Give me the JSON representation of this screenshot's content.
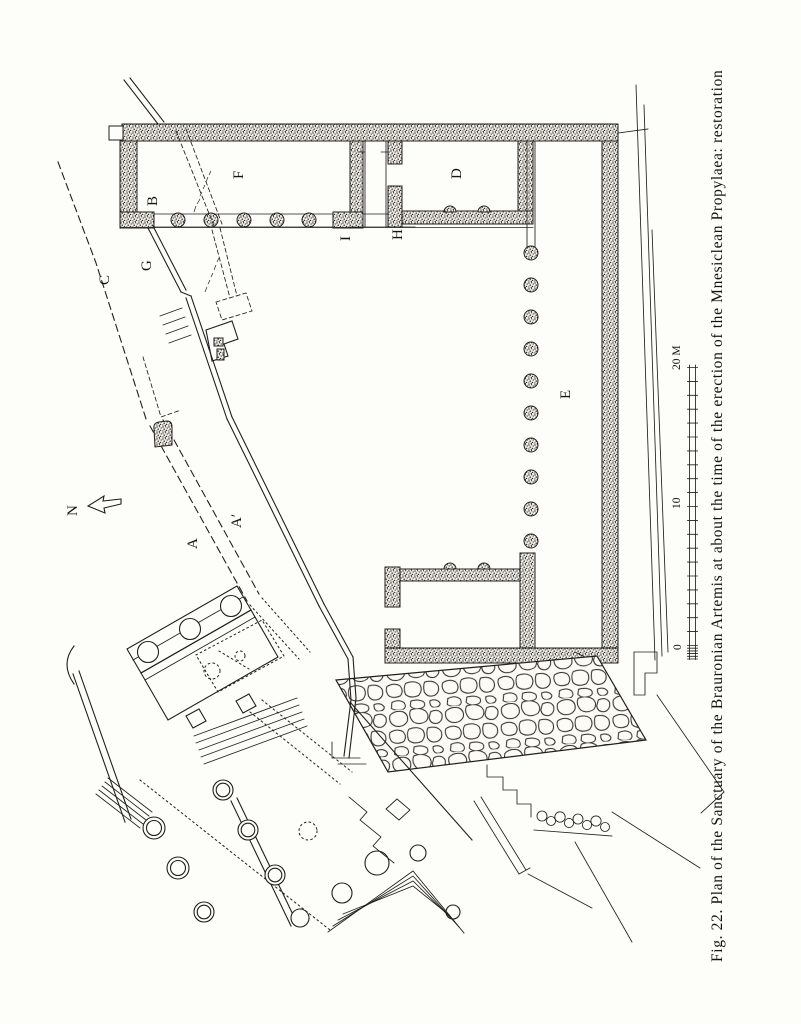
{
  "figure": {
    "caption": "Fig. 22.  Plan of the Sanctuary of the Brauronian Artemis at about the time of the erection of the Mnesiclean Propylaea: restoration"
  },
  "palette": {
    "paper": "#fdfdfa",
    "ink": "#211f1b"
  },
  "plan_labels": [
    {
      "id": "b",
      "text": "B",
      "x": 157,
      "y": 206
    },
    {
      "id": "f",
      "text": "F",
      "x": 243,
      "y": 179
    },
    {
      "id": "i",
      "text": "I",
      "x": 350,
      "y": 241
    },
    {
      "id": "h",
      "text": "H",
      "x": 402,
      "y": 240
    },
    {
      "id": "d",
      "text": "D",
      "x": 461,
      "y": 179
    },
    {
      "id": "e",
      "text": "E",
      "x": 570,
      "y": 399
    },
    {
      "id": "g",
      "text": "G",
      "x": 151,
      "y": 271
    },
    {
      "id": "c",
      "text": "C",
      "x": 109,
      "y": 285
    },
    {
      "id": "a",
      "text": "A",
      "x": 197,
      "y": 549
    },
    {
      "id": "a-prime",
      "text": "A′",
      "x": 241,
      "y": 528
    },
    {
      "id": "north-letter",
      "text": "N",
      "x": 77,
      "y": 516
    }
  ],
  "scale_bar": {
    "unit": "M",
    "unit_labels": [
      {
        "id": "zero",
        "text": "0",
        "x": 681,
        "y": 650
      },
      {
        "id": "ten",
        "text": "10",
        "x": 680,
        "y": 509
      },
      {
        "id": "twenty",
        "text": "20 M",
        "x": 680,
        "y": 370
      }
    ]
  }
}
